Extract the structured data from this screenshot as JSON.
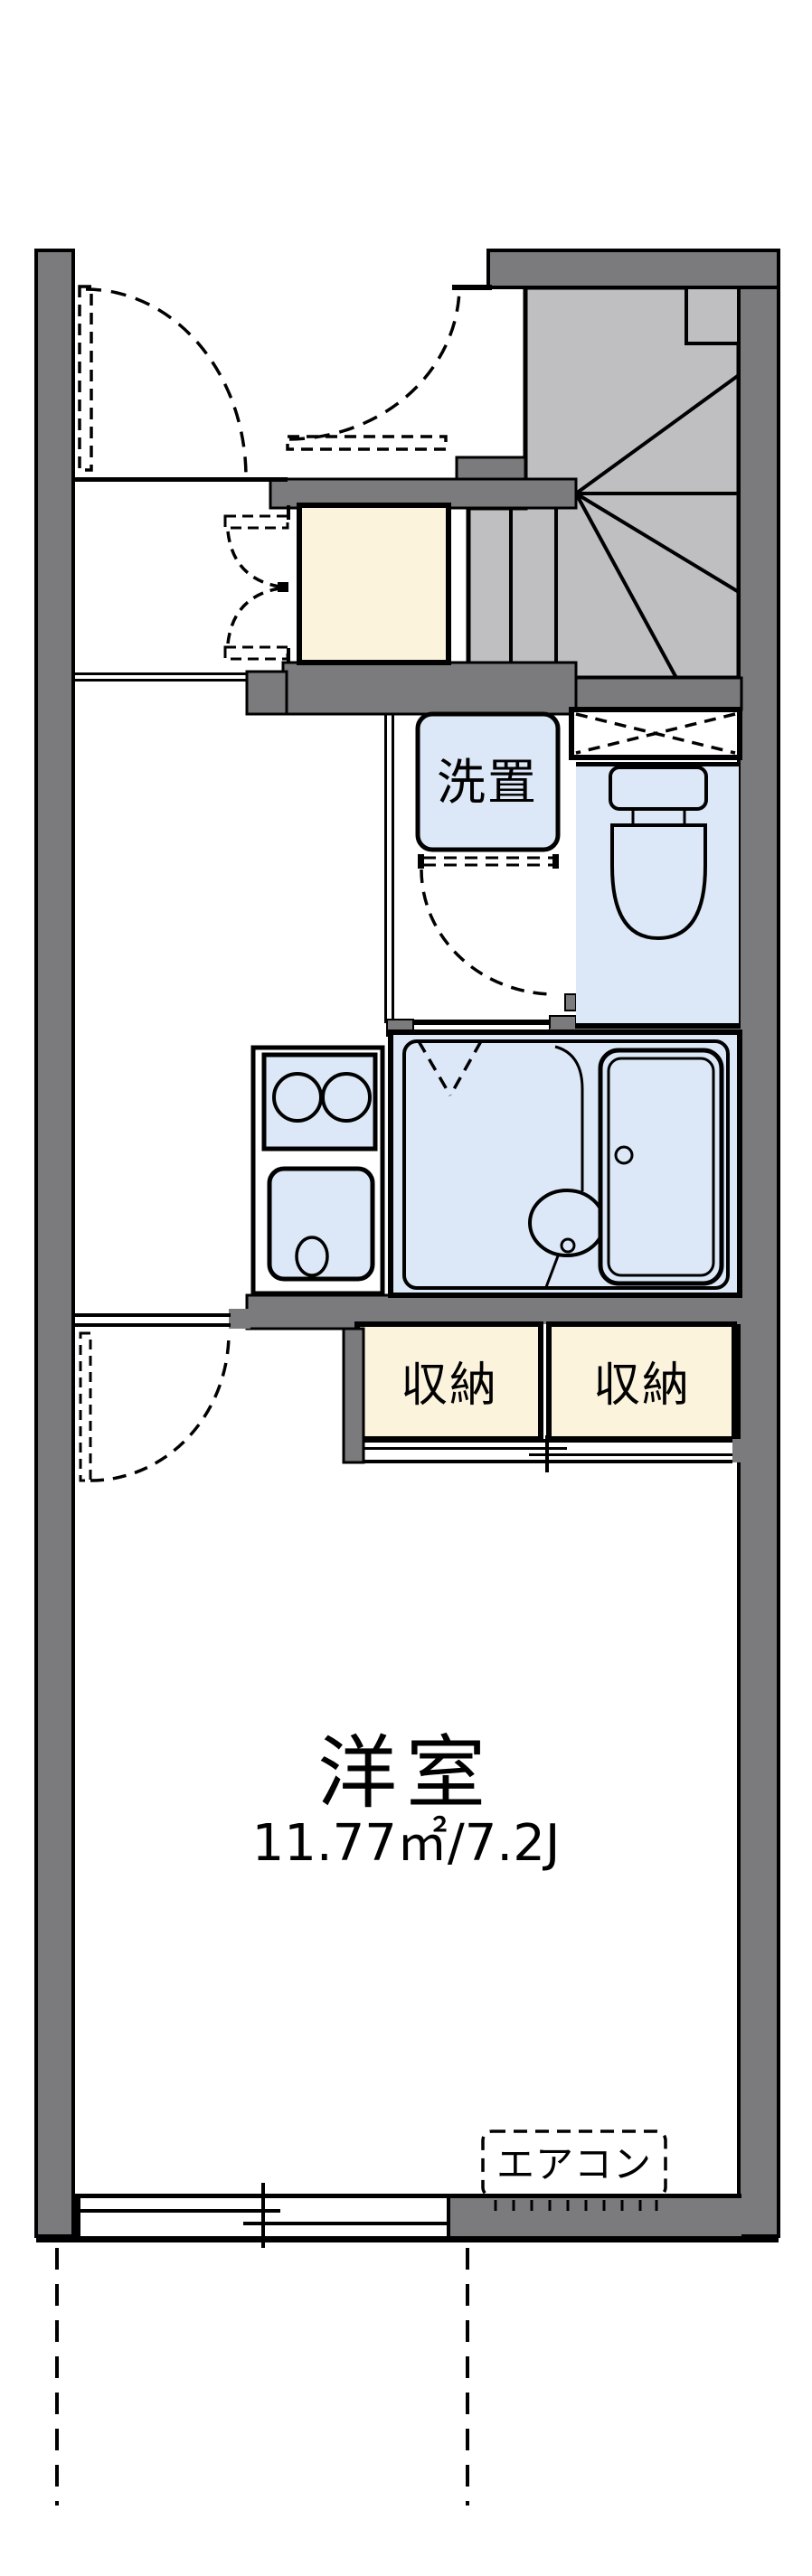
{
  "floorplan": {
    "type": "japanese-apartment-floor-plan",
    "rooms": {
      "western_room": {
        "label": "洋室",
        "area_label": "11.77㎡/7.2J"
      },
      "washer_space": {
        "label": "洗置"
      },
      "storage_left": {
        "label": "収納"
      },
      "storage_right": {
        "label": "収納"
      },
      "air_conditioner": {
        "label": "エアコン"
      }
    },
    "colors": {
      "wall": "#7b7b7e",
      "stair_fill": "#bfbfc1",
      "fixture_fill": "#dce8f7",
      "storage_fill": "#fcf3dd",
      "line": "#000000",
      "paper": "#ffffff"
    }
  }
}
